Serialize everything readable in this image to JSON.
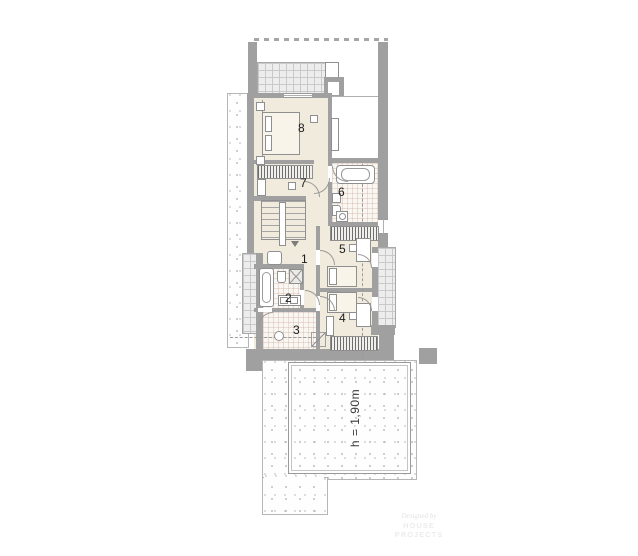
{
  "plan": {
    "type": "architectural floor plan, upper storey",
    "height_note_location": "lower roof area"
  },
  "rooms": [
    {
      "number": "1"
    },
    {
      "number": "2"
    },
    {
      "number": "3"
    },
    {
      "number": "4"
    },
    {
      "number": "5"
    },
    {
      "number": "6"
    },
    {
      "number": "7"
    },
    {
      "number": "8"
    }
  ],
  "labels": {
    "height": "h = 1,90m"
  },
  "watermark": {
    "line1": "Designed by",
    "line2": "HOUSE PROJECTS"
  },
  "colors": {
    "wall": "#a0a0a0",
    "floor": "#f1ebdd",
    "tile": "#faf6f1",
    "gridbg": "#ededed",
    "gridline": "#c9c9c9",
    "outline": "#8f8f8f",
    "dash": "#9a9a9a",
    "dot": "#9b9b9b",
    "text": "#1b1b1b"
  }
}
